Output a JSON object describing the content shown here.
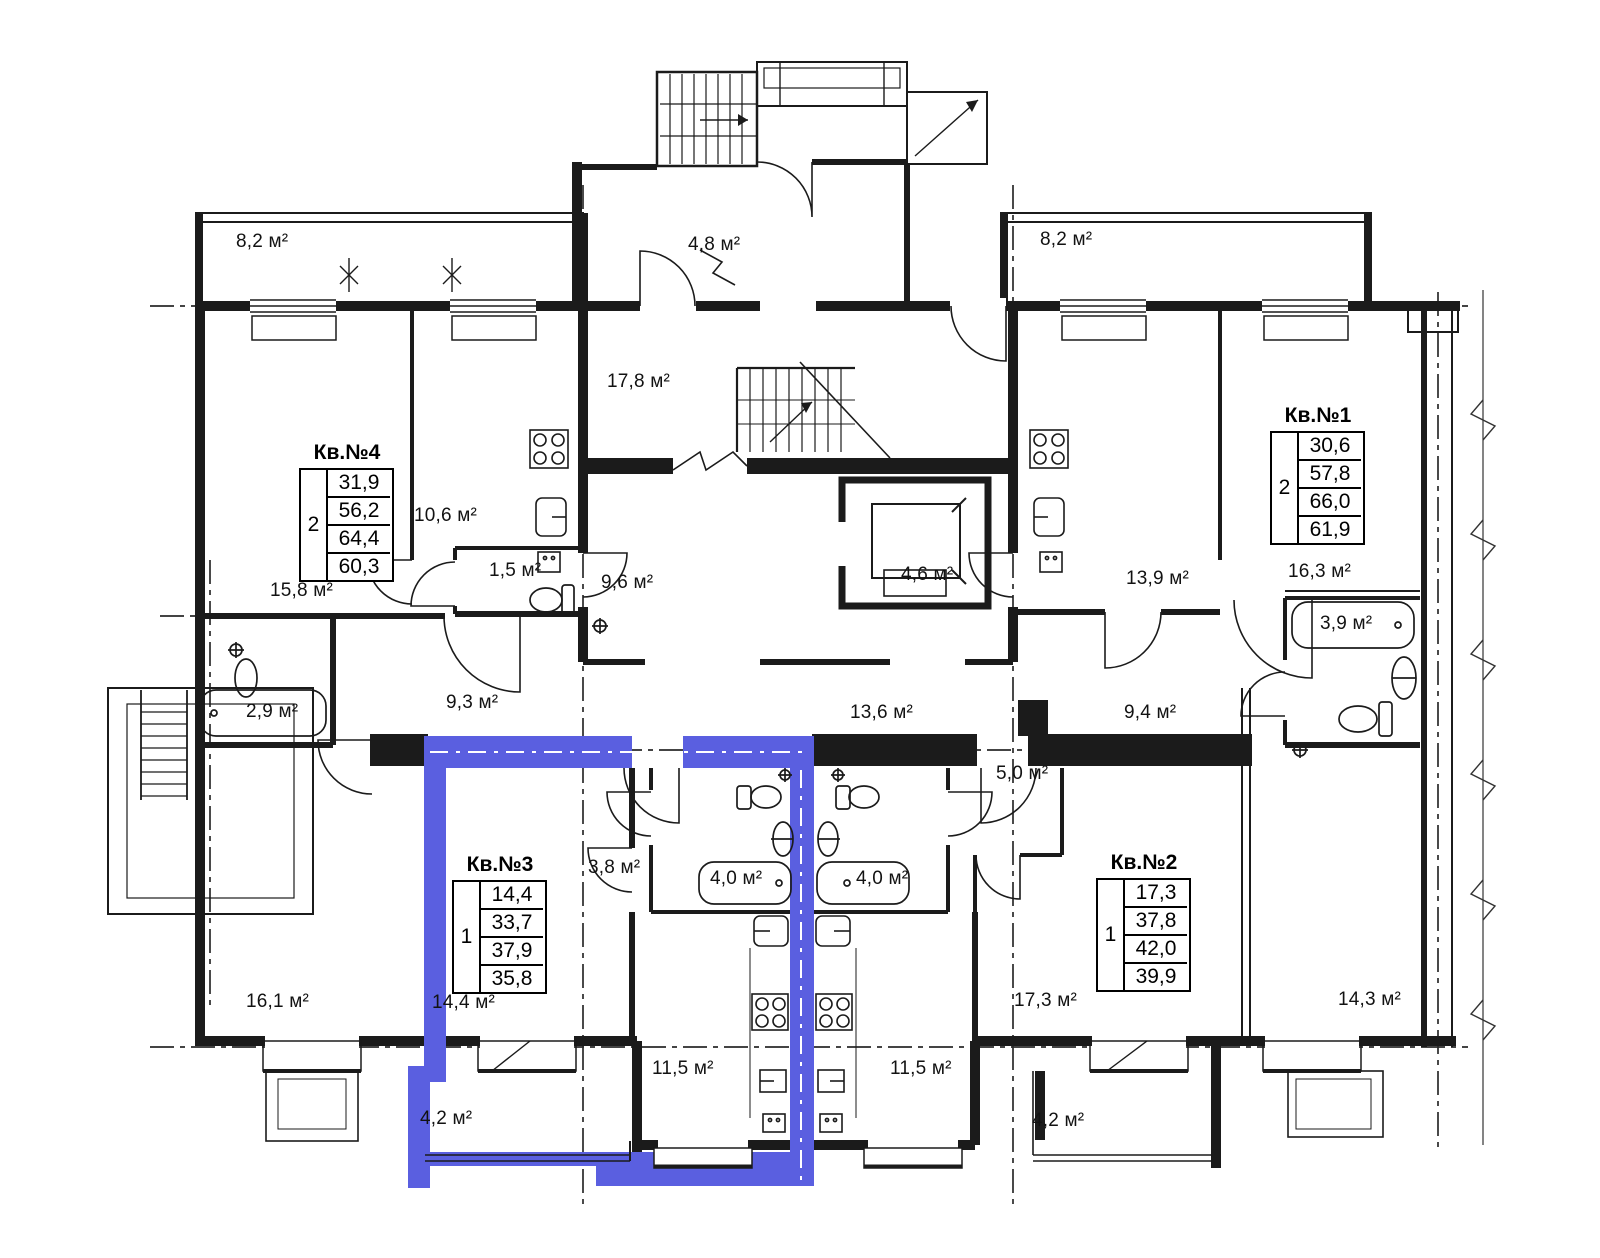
{
  "plan": {
    "type": "apartment-floor-plan",
    "units": "м²",
    "highlight_color": "#5a5fe0",
    "line_color": "#1b1b1b",
    "highlighted_apartment": "Кв.№3",
    "apartments": [
      {
        "id": "kv1",
        "title": "Кв.№1",
        "rooms": "2",
        "areas": [
          "30,6",
          "57,8",
          "66,0",
          "61,9"
        ],
        "highlighted": false
      },
      {
        "id": "kv2",
        "title": "Кв.№2",
        "rooms": "1",
        "areas": [
          "17,3",
          "37,8",
          "42,0",
          "39,9"
        ],
        "highlighted": false
      },
      {
        "id": "kv3",
        "title": "Кв.№3",
        "rooms": "1",
        "areas": [
          "14,4",
          "33,7",
          "37,9",
          "35,8"
        ],
        "highlighted": true
      },
      {
        "id": "kv4",
        "title": "Кв.№4",
        "rooms": "2",
        "areas": [
          "31,9",
          "56,2",
          "64,4",
          "60,3"
        ],
        "highlighted": false
      }
    ],
    "room_labels": [
      {
        "name": "balcony-top-left",
        "text": "8,2 м²"
      },
      {
        "name": "porch-vestibule",
        "text": "4,8 м²"
      },
      {
        "name": "balcony-top-right",
        "text": "8,2 м²"
      },
      {
        "name": "hall-central",
        "text": "17,8 м²"
      },
      {
        "name": "kitchen-kv4",
        "text": "10,6 м²"
      },
      {
        "name": "wc-kv4",
        "text": "1,5 м²"
      },
      {
        "name": "corridor-mid",
        "text": "9,6 м²"
      },
      {
        "name": "elevator",
        "text": "4,6 м²"
      },
      {
        "name": "kitchen-kv1",
        "text": "13,9 м²"
      },
      {
        "name": "room-16-3",
        "text": "16,3 м²"
      },
      {
        "name": "bath-kv1",
        "text": "3,9 м²"
      },
      {
        "name": "room-15-8",
        "text": "15,8 м²"
      },
      {
        "name": "bath-kv4",
        "text": "2,9 м²"
      },
      {
        "name": "corridor-left",
        "text": "9,3 м²"
      },
      {
        "name": "corridor-center",
        "text": "13,6 м²"
      },
      {
        "name": "corridor-right",
        "text": "9,4 м²"
      },
      {
        "name": "storage",
        "text": "5,0 м²"
      },
      {
        "name": "hall-kv3",
        "text": "3,8 м²"
      },
      {
        "name": "bath-kv3",
        "text": "4,0 м²"
      },
      {
        "name": "bath-kv2",
        "text": "4,0 м²"
      },
      {
        "name": "room-16-1",
        "text": "16,1 м²"
      },
      {
        "name": "room-kv3",
        "text": "14,4 м²"
      },
      {
        "name": "room-kv2",
        "text": "17,3 м²"
      },
      {
        "name": "room-14-3",
        "text": "14,3 м²"
      },
      {
        "name": "kitchen-kv3",
        "text": "11,5 м²"
      },
      {
        "name": "kitchen-kv2",
        "text": "11,5 м²"
      },
      {
        "name": "balcony-kv3",
        "text": "4,2 м²"
      },
      {
        "name": "balcony-kv2",
        "text": "4,2 м²"
      }
    ]
  }
}
